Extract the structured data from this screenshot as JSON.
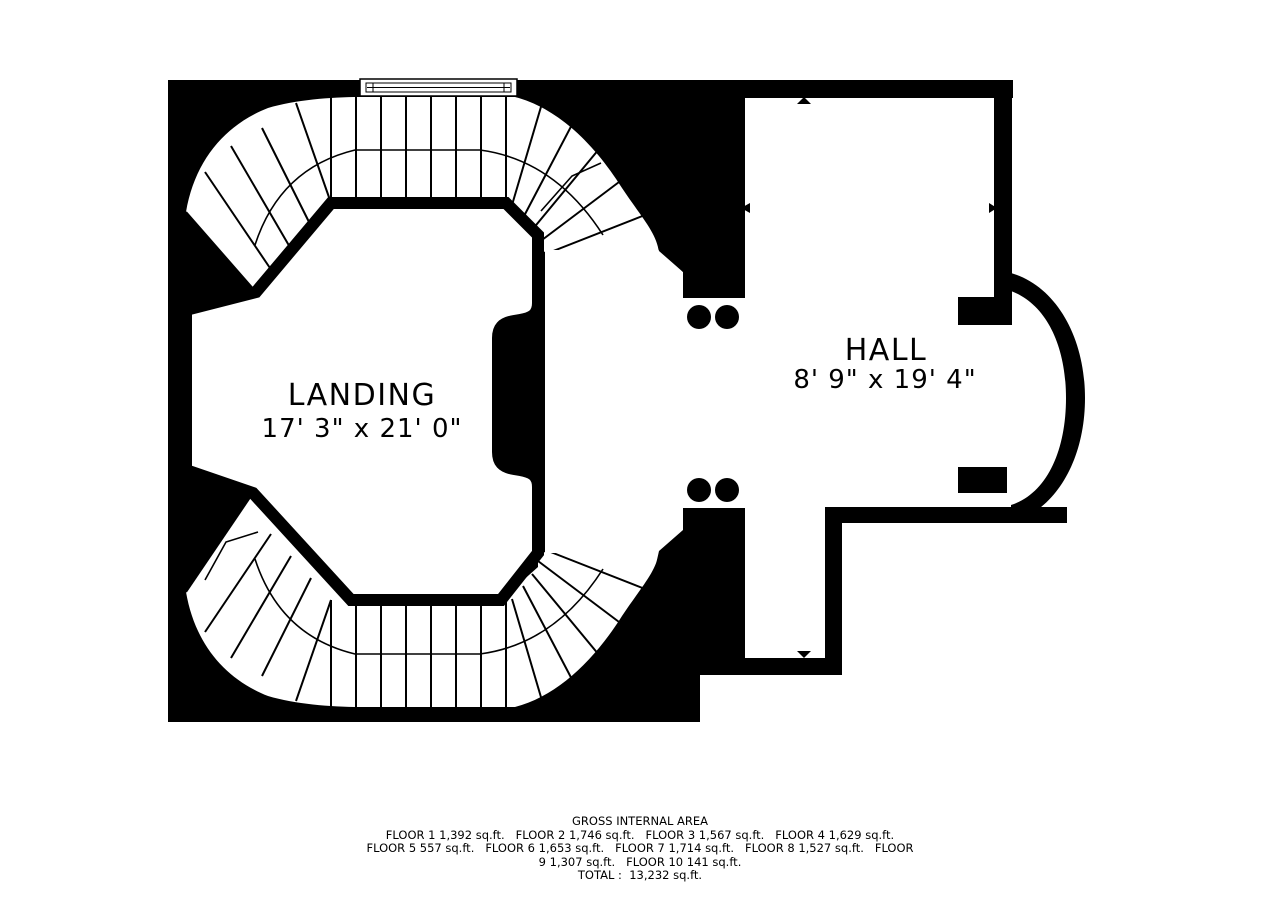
{
  "plan": {
    "type": "floor-plan",
    "colors": {
      "wall": "#000000",
      "background": "#ffffff"
    },
    "rooms": {
      "landing": {
        "name": "LANDING",
        "dimensions": "17' 3\" x 21' 0\""
      },
      "hall": {
        "name": "HALL",
        "dimensions": "8' 9\" x 19' 4\""
      }
    },
    "features": [
      "curved-double-staircase",
      "stair-window",
      "four-columns",
      "bow-bay-window"
    ]
  },
  "footer": {
    "title": "GROSS INTERNAL AREA",
    "lines": [
      "FLOOR 1 1,392 sq.ft.   FLOOR 2 1,746 sq.ft.   FLOOR 3 1,567 sq.ft.   FLOOR 4 1,629 sq.ft.",
      "FLOOR 5 557 sq.ft.   FLOOR 6 1,653 sq.ft.   FLOOR 7 1,714 sq.ft.   FLOOR 8 1,527 sq.ft.   FLOOR",
      "9 1,307 sq.ft.   FLOOR 10 141 sq.ft.",
      "TOTAL :  13,232 sq.ft."
    ],
    "floors": [
      {
        "label": "FLOOR 1",
        "area": "1,392 sq.ft."
      },
      {
        "label": "FLOOR 2",
        "area": "1,746 sq.ft."
      },
      {
        "label": "FLOOR 3",
        "area": "1,567 sq.ft."
      },
      {
        "label": "FLOOR 4",
        "area": "1,629 sq.ft."
      },
      {
        "label": "FLOOR 5",
        "area": "557 sq.ft."
      },
      {
        "label": "FLOOR 6",
        "area": "1,653 sq.ft."
      },
      {
        "label": "FLOOR 7",
        "area": "1,714 sq.ft."
      },
      {
        "label": "FLOOR 8",
        "area": "1,527 sq.ft."
      },
      {
        "label": "FLOOR 9",
        "area": "1,307 sq.ft."
      },
      {
        "label": "FLOOR 10",
        "area": "141 sq.ft."
      }
    ],
    "total": "13,232 sq.ft."
  }
}
